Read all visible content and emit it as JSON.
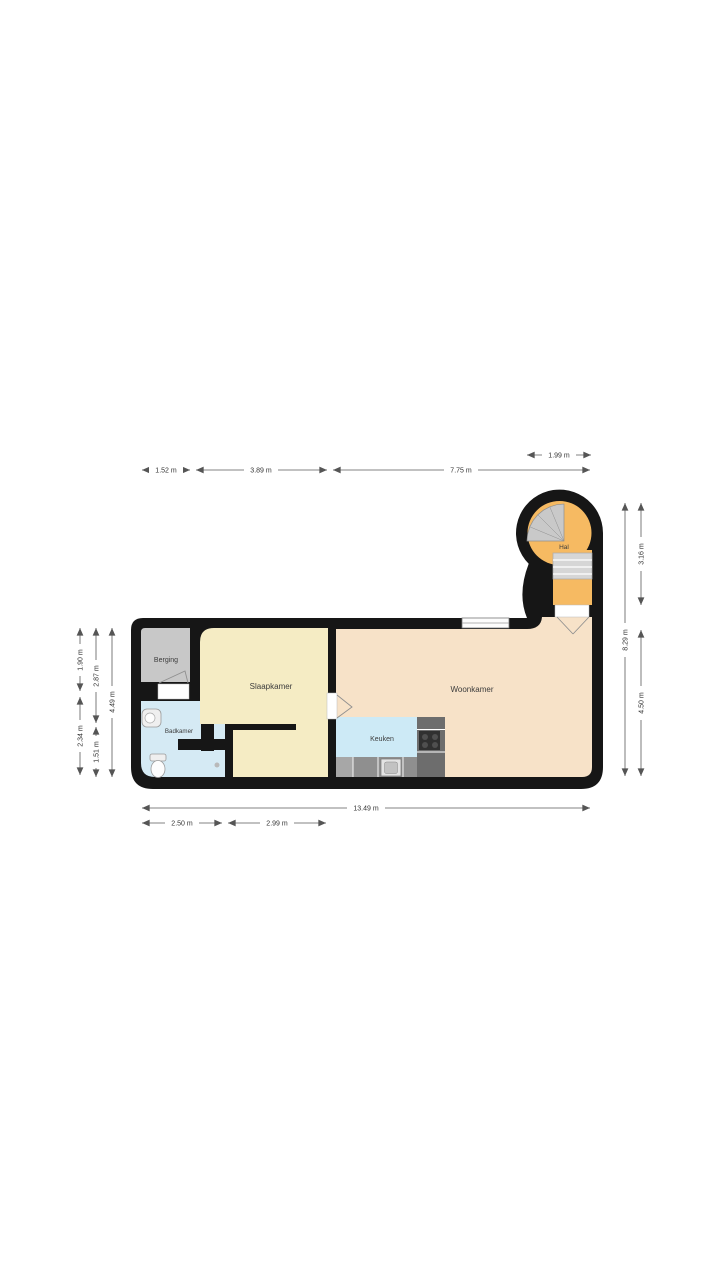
{
  "rooms": {
    "berging": "Berging",
    "slaapkamer": "Slaapkamer",
    "badkamer": "Badkamer",
    "woonkamer": "Woonkamer",
    "keuken": "Keuken",
    "hal": "Hal"
  },
  "dimensions": {
    "hal_width": "1.99 m",
    "berging_width": "1.52 m",
    "slaapkamer_width": "3.89 m",
    "woonkamer_width": "7.75 m",
    "height_total": "8.29 m",
    "hal_height": "3.16 m",
    "woonkamer_height": "4.50 m",
    "berging_height": "1.90 m",
    "badkamer_height": "2.34 m",
    "slaapkamer_height": "2.87 m",
    "slaapkamer_lower_height": "1.51 m",
    "left_total_height": "4.49 m",
    "width_total": "13.49 m",
    "badkamer_width": "2.50 m",
    "slaapkamer_lower_width": "2.99 m"
  },
  "colors": {
    "wall": "#161616",
    "berging": "#c8c8c8",
    "slaapkamer": "#f5ecc4",
    "badkamer": "#d5eaf4",
    "woonkamer": "#f7e2c8",
    "keuken": "#cdeaf6",
    "hal": "#f6ba62",
    "stairs": "#d6d6d6",
    "spiral_stairs": "#c9c9c9",
    "counter_dark": "#6d6d6d",
    "counter_mid": "#8f8f8f",
    "counter_light": "#a7a7a7",
    "cooktop": "#303030"
  }
}
